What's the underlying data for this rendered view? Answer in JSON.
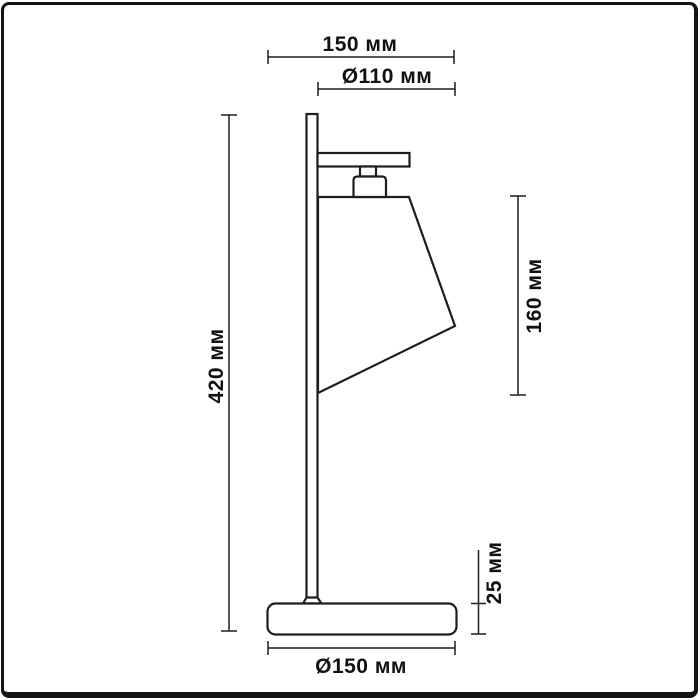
{
  "colors": {
    "background": "#ffffff",
    "line": "#1d1d1d",
    "text": "#111111",
    "frame": "#141414"
  },
  "dimensions": {
    "arm_length": {
      "value": 150,
      "unit": "мм",
      "label": "150 мм"
    },
    "shade_diameter": {
      "value": 110,
      "unit": "мм",
      "label": "Ø110 мм"
    },
    "total_height": {
      "value": 420,
      "unit": "мм",
      "label": "420 мм"
    },
    "shade_height": {
      "value": 160,
      "unit": "мм",
      "label": "160 мм"
    },
    "base_height": {
      "value": 25,
      "unit": "мм",
      "label": "25 мм"
    },
    "base_diameter": {
      "value": 150,
      "unit": "мм",
      "label": "Ø150 мм"
    }
  }
}
